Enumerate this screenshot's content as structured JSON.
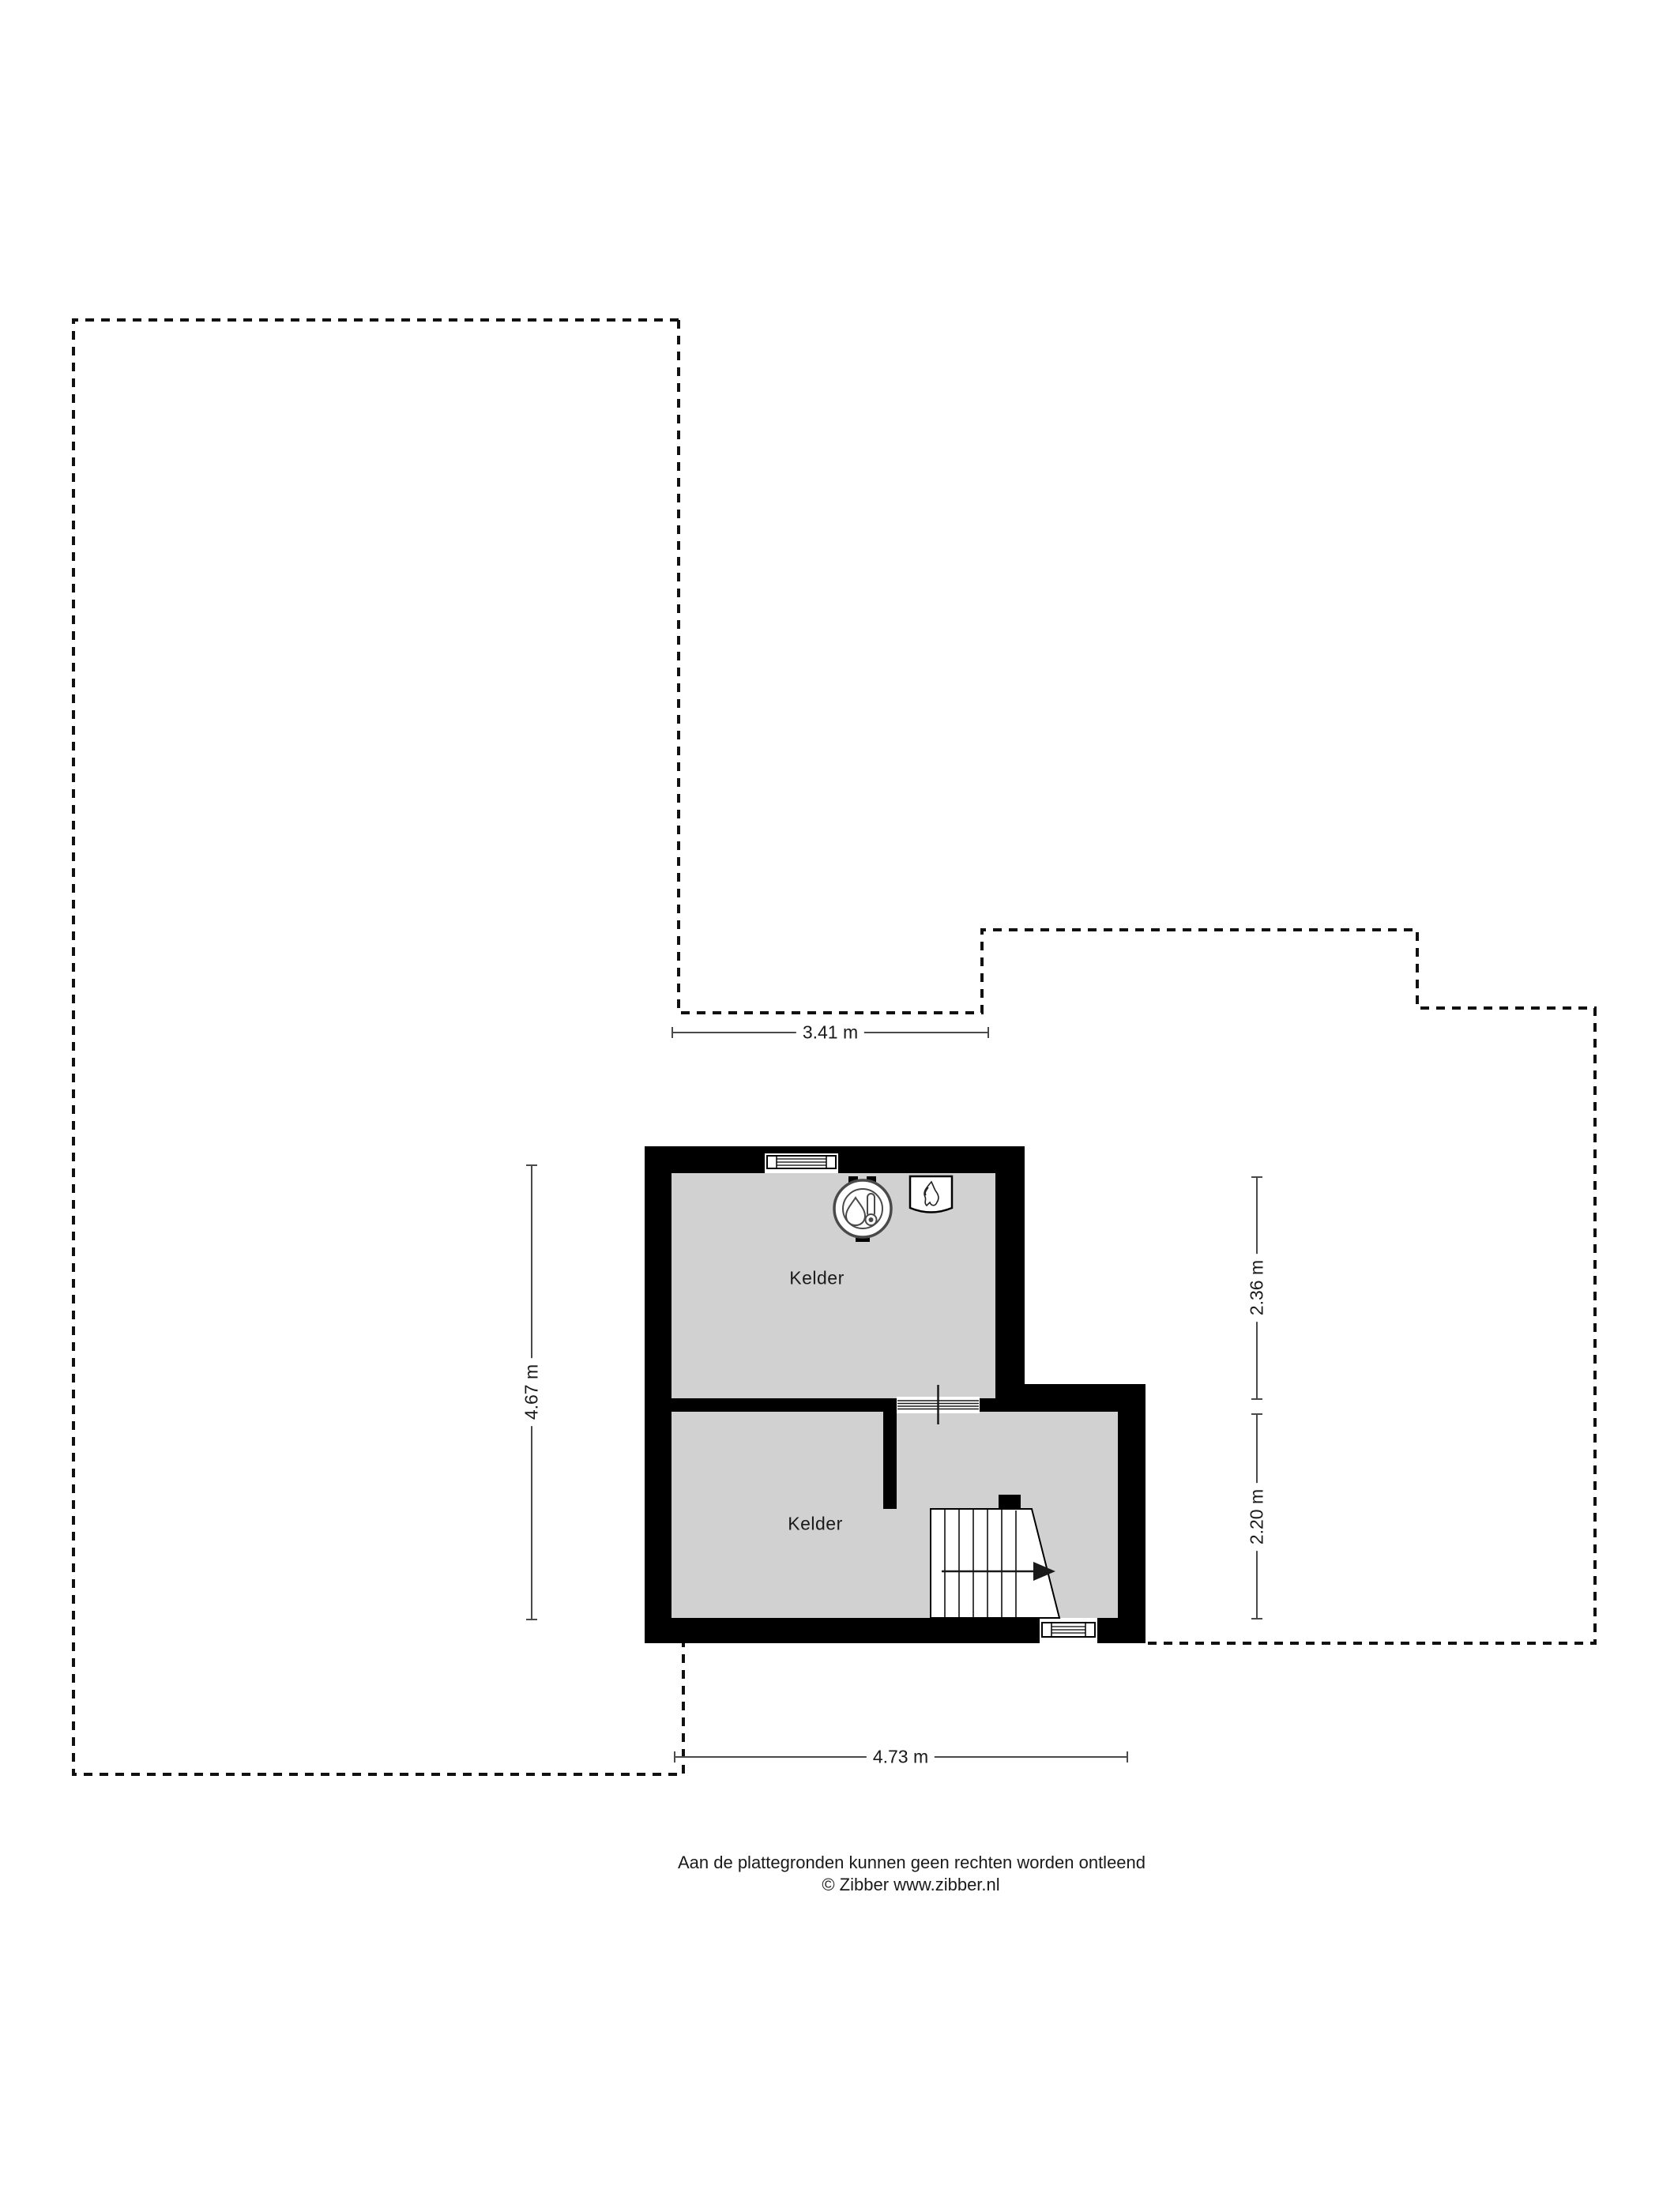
{
  "plan": {
    "rooms": [
      {
        "label": "Kelder"
      },
      {
        "label": "Kelder"
      }
    ],
    "dimensions": {
      "top": "3.41 m",
      "bottom": "4.73 m",
      "left": "4.67 m",
      "right_upper": "2.36 m",
      "right_lower": "2.20 m"
    },
    "icons": [
      {
        "name": "boiler-icon"
      },
      {
        "name": "heater-icon"
      }
    ]
  },
  "footer": {
    "disclaimer": "Aan de plattegronden kunnen geen rechten worden ontleend",
    "copyright": "© Zibber www.zibber.nl"
  },
  "colors": {
    "wall": "#000000",
    "floor": "#d1d1d1",
    "dimension_line": "#4a4a4a",
    "outline": "#111111",
    "text": "#1a1a1a",
    "background": "#ffffff"
  }
}
